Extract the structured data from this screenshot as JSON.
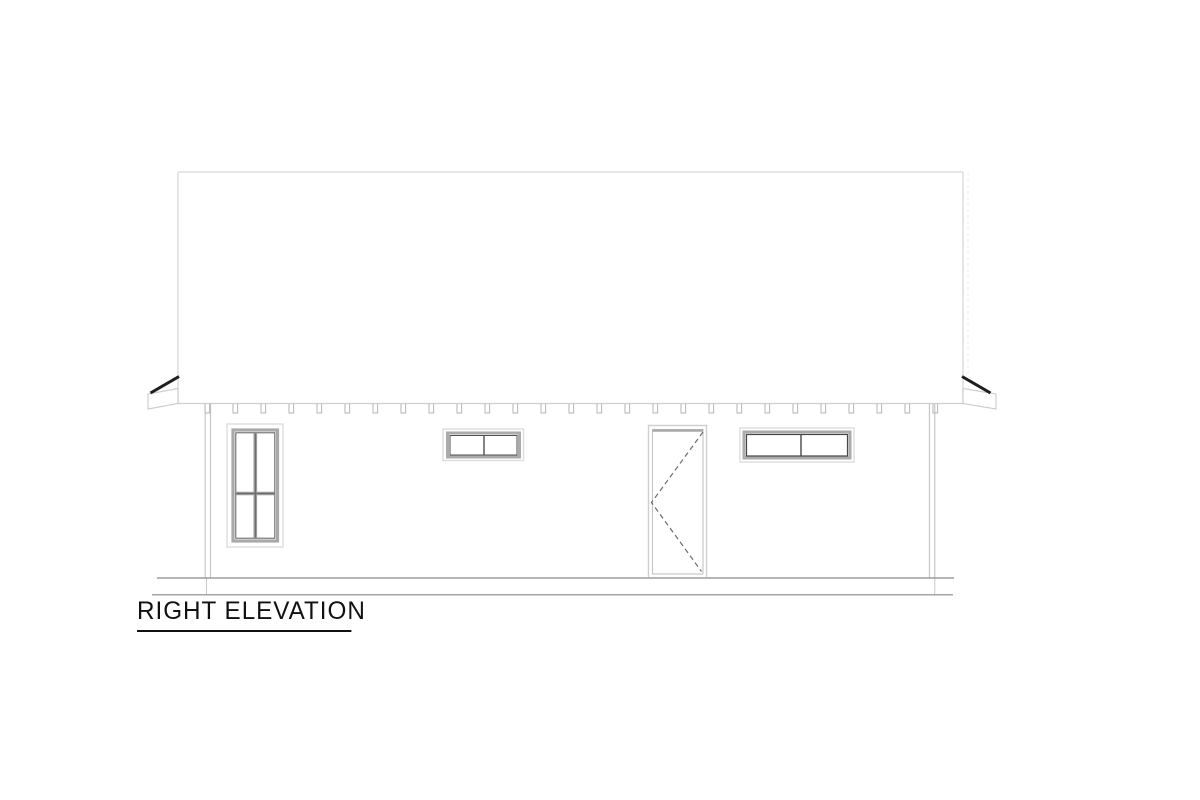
{
  "sheet": {
    "background": "#ffffff",
    "kind": "architectural elevation line drawing"
  },
  "drawing": {
    "title": "RIGHT ELEVATION",
    "colors": {
      "paper": "#ffffff",
      "roof_outline": "#dedede",
      "eave_outline": "#cfcfcf",
      "window_outer": "#dddddd",
      "window_band": "#a9a9a9",
      "window_sash_dark": "#4f4f4f",
      "mullion_gray": "#9a9a9a",
      "door_frame": "#cfcfcf",
      "door_swing_dash": "#6b6b6b",
      "rafter_tail": "#b5b5b5",
      "corner_post": "#bdbdbd",
      "ground_line": "#8a8a8a",
      "rake_board_dark": "#1f1f1f",
      "title_text": "#111111"
    },
    "rafter_tails": {
      "count": 27,
      "start_x": 205,
      "step": 28,
      "top_y": 404,
      "depth": 9,
      "width": 4.6
    },
    "features": {
      "roof": "gable roof plane, rectangular outline",
      "left_window": "tall 4-pane double-hung window",
      "middle_window": "small horizontal 2-pane window",
      "door": "single door with dashed swing indicator",
      "right_window": "wide horizontal 2-pane window",
      "ground": "double grade line"
    }
  }
}
